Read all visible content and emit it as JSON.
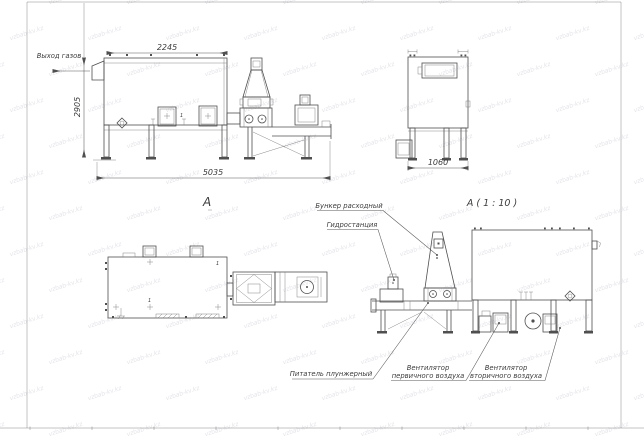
{
  "watermark": {
    "text": "vzbab-kv.kz"
  },
  "drawing": {
    "dim_top": "2245",
    "dim_height": "2905",
    "dim_length": "5035",
    "dim_end_width": "1060",
    "gas_outlet": "Выход газов",
    "view_label": "А",
    "detail_label": "А ( 1 : 10 )",
    "hopper_label": "Бункер расходный",
    "hydrostation_label": "Гидростанция",
    "feeder_label": "Питатель плунжерный",
    "fan_primary_line1": "Вентилятор",
    "fan_primary_line2": "первичного воздуха",
    "fan_secondary_line1": "Вентилятор",
    "fan_secondary_line2": "вторичного воздуха",
    "callout": "1"
  },
  "colors": {
    "line": "#4f4f4f",
    "watermark": "#e4e4ea"
  }
}
